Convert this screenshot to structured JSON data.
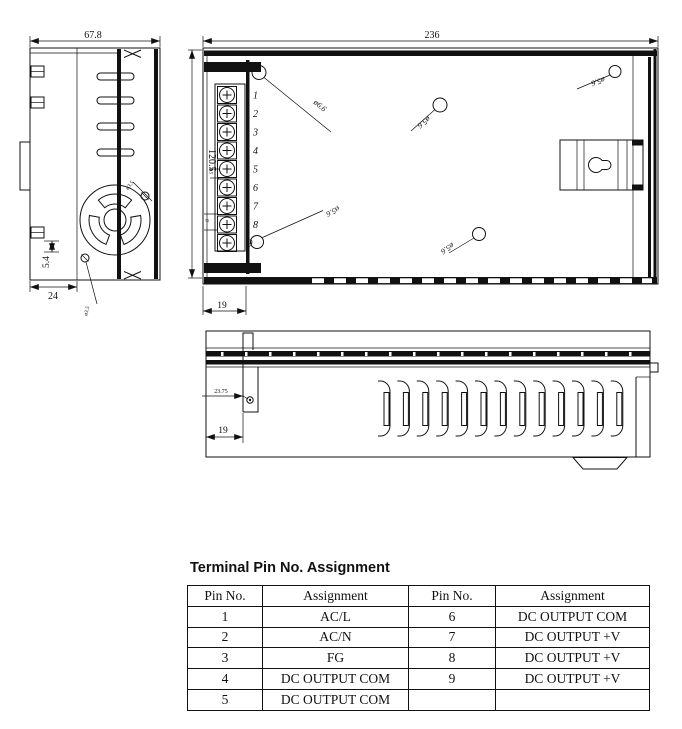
{
  "drawing": {
    "side_view": {
      "dim_width": "67.8",
      "dim_fan_offset": "24",
      "dim_bottom": "5.4",
      "fan_hole_top": "ø3.5",
      "fan_hole_bottom": "ø3.5"
    },
    "top_view": {
      "dim_length": "236",
      "dim_height": "120.5",
      "dim_terminal_depth": "19",
      "hole_top_left": "ø6.6",
      "hole_mid": "ø5.6",
      "hole_top_right": "ø5.6",
      "hole_bottom_right": "ø5.6",
      "hole_terminal": "ø5.6",
      "pitch_small": "4.5",
      "pitch_end": "8",
      "terminal_numbers": [
        "1",
        "2",
        "3",
        "4",
        "5",
        "6",
        "7",
        "8",
        "9"
      ]
    },
    "front_view": {
      "dim_hole_offset": "23.75",
      "dim_terminal_depth": "19"
    }
  },
  "table": {
    "title": "Terminal Pin No. Assignment",
    "headers": [
      "Pin No.",
      "Assignment",
      "Pin No.",
      "Assignment"
    ],
    "rows": [
      [
        "1",
        "AC/L",
        "6",
        "DC OUTPUT COM"
      ],
      [
        "2",
        "AC/N",
        "7",
        "DC OUTPUT +V"
      ],
      [
        "3",
        "FG",
        "8",
        "DC OUTPUT +V"
      ],
      [
        "4",
        "DC OUTPUT COM",
        "9",
        "DC OUTPUT +V"
      ],
      [
        "5",
        "DC OUTPUT COM",
        "",
        ""
      ]
    ]
  }
}
